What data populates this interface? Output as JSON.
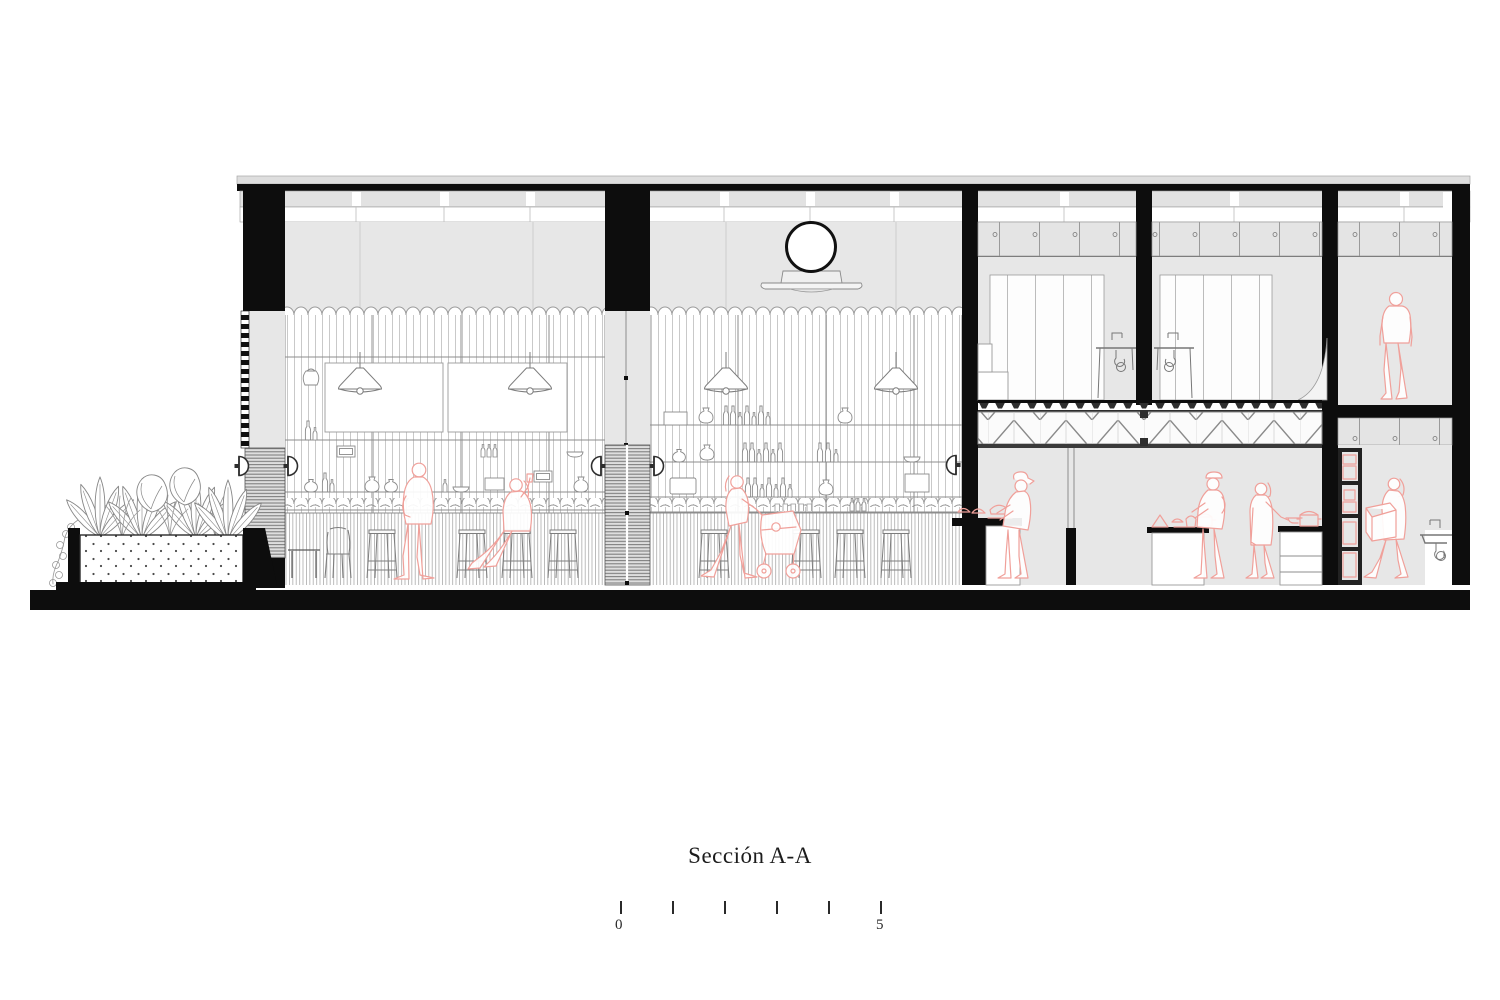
{
  "title": {
    "text": "Sección A-A"
  },
  "scale_bar": {
    "ticks": 6,
    "start_label": "0",
    "end_label": "5"
  },
  "colors": {
    "ink": "#0d0d0d",
    "line": "#8d8d8d",
    "line_dark": "#5a5a5a",
    "line_light": "#c4c4c4",
    "wall_fill": "#e7e7e7",
    "panel_fill": "#f1f1f1",
    "figure_red": "#f0a09a",
    "paper": "#ffffff"
  }
}
